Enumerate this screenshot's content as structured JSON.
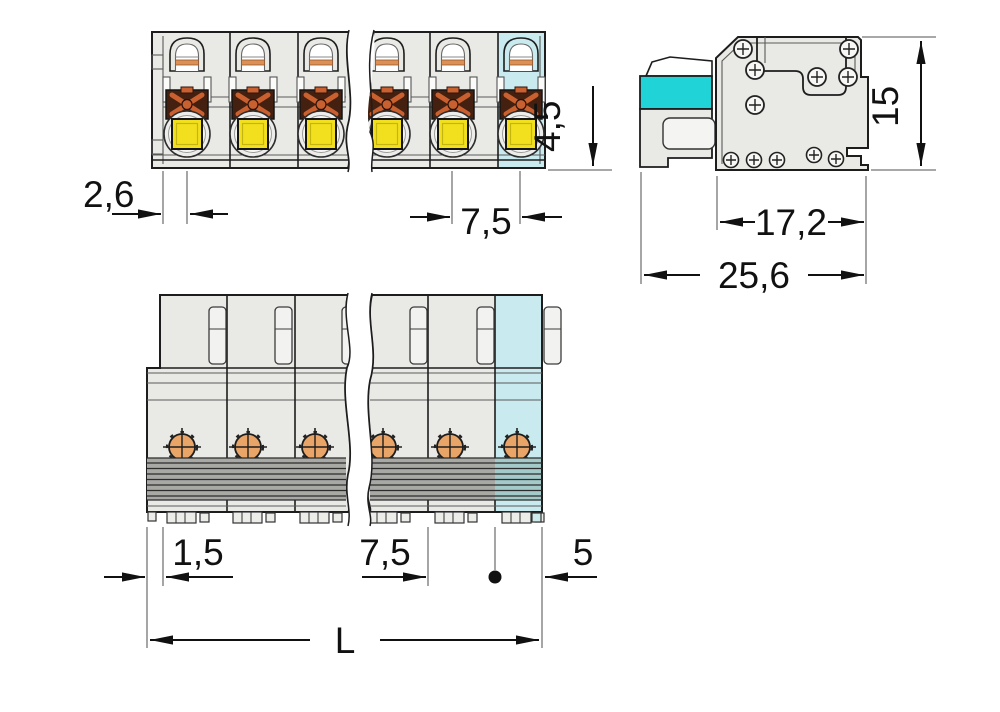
{
  "drawing": {
    "dims": {
      "front_entry_offset": "2,6",
      "front_pitch": "7,5",
      "button_travel": "4,5",
      "side_height": "15",
      "side_depth_inner": "17,2",
      "side_depth_total": "25,6",
      "bottom_lip": "1,5",
      "bottom_pitch": "7,5",
      "bottom_end": "5",
      "total_length": "L"
    },
    "colors": {
      "bg": "#ffffff",
      "body": "#e9e9e6",
      "body_light": "#f4f4f2",
      "cyan_pole": "#c9eaee",
      "cyan_feet": "#cfeaec",
      "turquoise": "#1fd3d6",
      "yellow": "#f2e01e",
      "contact_orange": "#e9a468",
      "clamp_dark": "#43200f",
      "clamp_orange": "#c96030",
      "clamp_orange_light": "#dd9055",
      "groove": "#a8a8a5",
      "groove_cyan": "#a3c9c8",
      "line_dark": "#1d1d1d",
      "line_mid": "#5a5a5a",
      "dim": "#111111",
      "ext": "#757575"
    }
  }
}
